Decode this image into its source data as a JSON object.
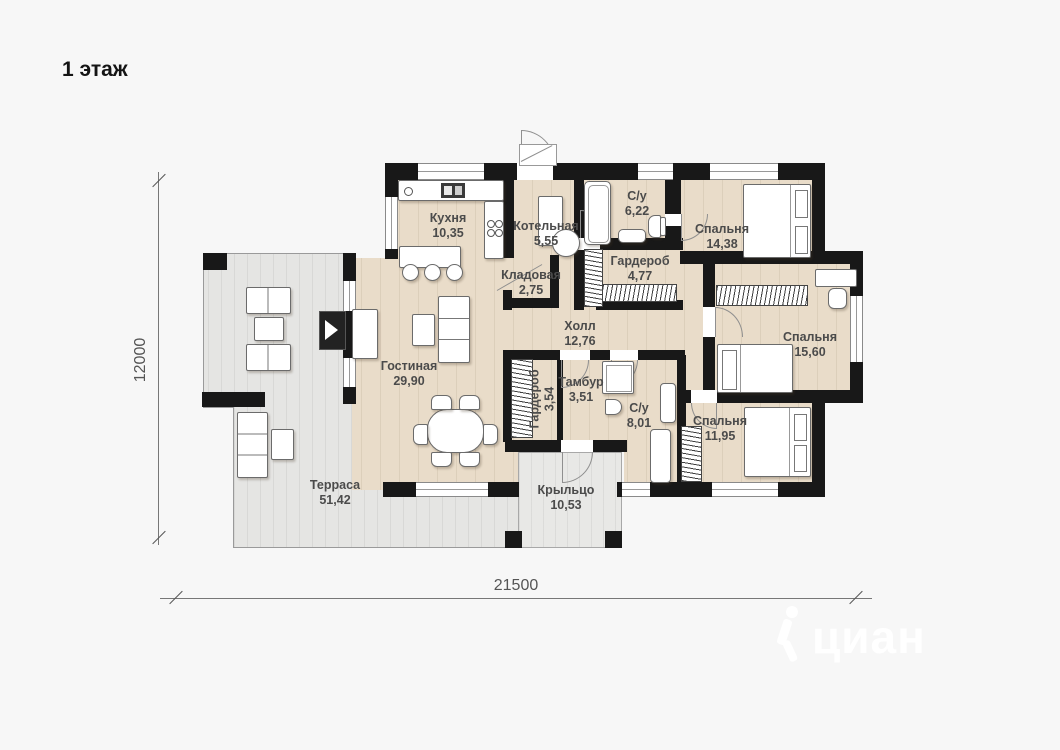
{
  "title": "1 этаж",
  "dimensions": {
    "horizontal": "21500",
    "vertical": "12000"
  },
  "watermark": {
    "brand": "циан"
  },
  "rooms": [
    {
      "id": "kitchen",
      "name": "Кухня",
      "area": "10,35",
      "x": 448,
      "y": 211,
      "vertical": false
    },
    {
      "id": "boiler",
      "name": "Котельная",
      "area": "5,55",
      "x": 546,
      "y": 219,
      "vertical": false
    },
    {
      "id": "bath-1",
      "name": "С/у",
      "area": "6,22",
      "x": 637,
      "y": 189,
      "vertical": false
    },
    {
      "id": "bedroom-1",
      "name": "Спальня",
      "area": "14,38",
      "x": 722,
      "y": 222,
      "vertical": false
    },
    {
      "id": "pantry",
      "name": "Кладовая",
      "area": "2,75",
      "x": 531,
      "y": 268,
      "vertical": false
    },
    {
      "id": "wardrobe-1",
      "name": "Гардероб",
      "area": "4,77",
      "x": 640,
      "y": 254,
      "vertical": false
    },
    {
      "id": "hall",
      "name": "Холл",
      "area": "12,76",
      "x": 580,
      "y": 319,
      "vertical": false
    },
    {
      "id": "bedroom-2",
      "name": "Спальня",
      "area": "15,60",
      "x": 810,
      "y": 330,
      "vertical": false
    },
    {
      "id": "living",
      "name": "Гостиная",
      "area": "29,90",
      "x": 409,
      "y": 359,
      "vertical": false
    },
    {
      "id": "wardrobe-2",
      "name": "Гардероб",
      "area": "3,54",
      "x": 542,
      "y": 399,
      "vertical": true
    },
    {
      "id": "vestibule",
      "name": "Тамбур",
      "area": "3,51",
      "x": 581,
      "y": 375,
      "vertical": false
    },
    {
      "id": "bath-2",
      "name": "С/у",
      "area": "8,01",
      "x": 639,
      "y": 401,
      "vertical": false
    },
    {
      "id": "bedroom-3",
      "name": "Спальня",
      "area": "11,95",
      "x": 720,
      "y": 414,
      "vertical": false
    },
    {
      "id": "terrace",
      "name": "Терраса",
      "area": "51,42",
      "x": 335,
      "y": 478,
      "vertical": false
    },
    {
      "id": "porch",
      "name": "Крыльцо",
      "area": "10,53",
      "x": 566,
      "y": 483,
      "vertical": false
    }
  ]
}
